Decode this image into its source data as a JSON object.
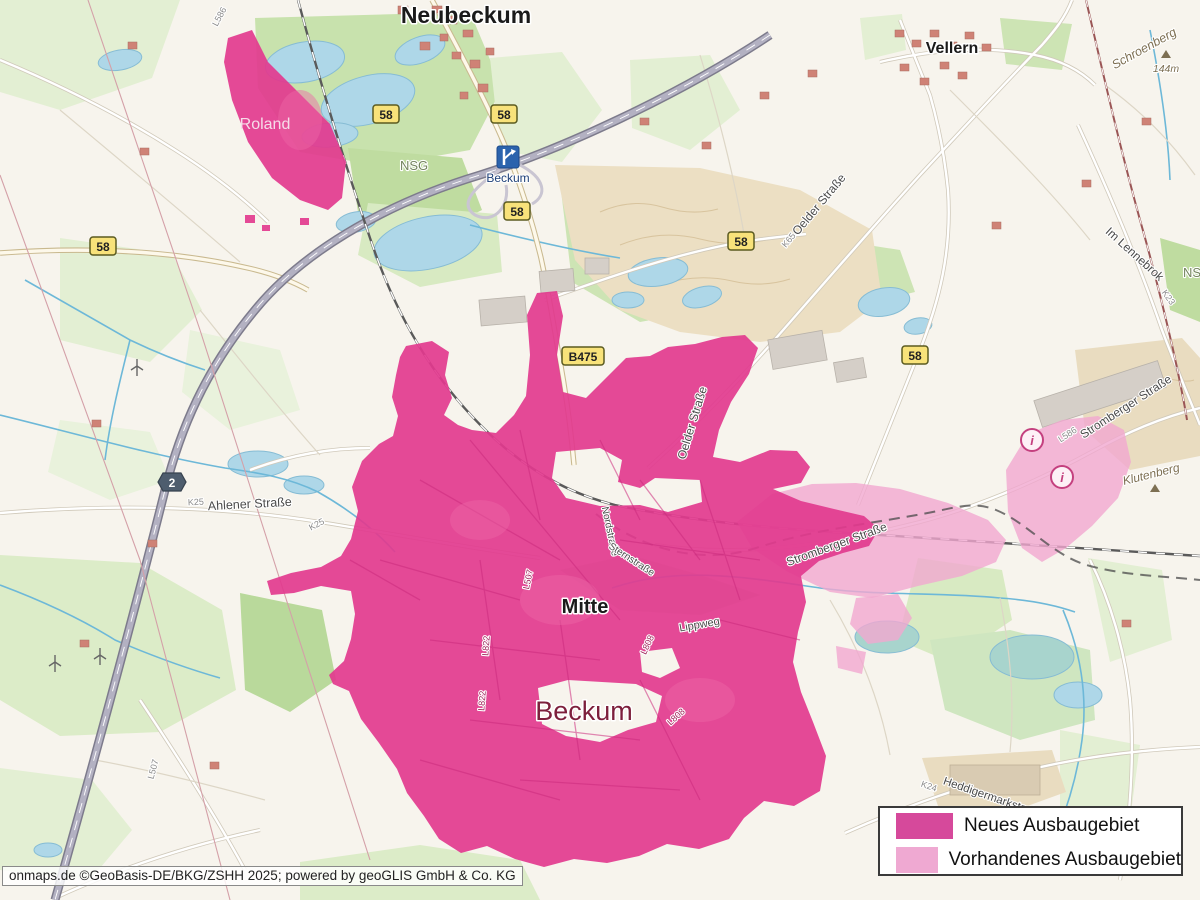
{
  "attribution": "onmaps.de ©GeoBasis-DE/BKG/ZSHH 2025; powered by geoGLIS GmbH & Co. KG",
  "places": {
    "neubeckum": "Neubeckum",
    "vellern": "Vellern",
    "roland": "Roland",
    "mitte": "Mitte",
    "beckum_city": "Beckum",
    "beckum_exit": "Beckum"
  },
  "streets": {
    "oelder": "Oelder Straße",
    "ahlener": "Ahlener Straße",
    "stromberger": "Stromberger Straße",
    "im_lennebrok": "Im Lennebrok",
    "heddigermark": "Heddigermarkstraße",
    "lippweg": "Lippweg",
    "nordstrasse": "Nordstraße",
    "sternstrasse": "Sternstraße"
  },
  "refs": {
    "b58": "58",
    "b475": "B475",
    "a2": "2",
    "l586": "L586",
    "l507": "L507",
    "l822": "L822",
    "l808": "L808",
    "k25": "K25",
    "k24": "K24",
    "k23": "K23",
    "k65": "K65"
  },
  "nature": {
    "nsg": "NSG"
  },
  "peaks": {
    "schroenberg": {
      "name": "Schroenberg",
      "elevation": "144m"
    },
    "klutenberg": {
      "name": "Klutenberg"
    }
  },
  "overlay_colors": {
    "new": "#e23a8e",
    "existing": "#f1a7d0"
  },
  "legend": {
    "items": [
      {
        "label": "Neues Ausbaugebiet",
        "color": "#d6499b"
      },
      {
        "label": "Vorhandenes Ausbaugebiet",
        "color": "#efa9d2"
      }
    ]
  }
}
